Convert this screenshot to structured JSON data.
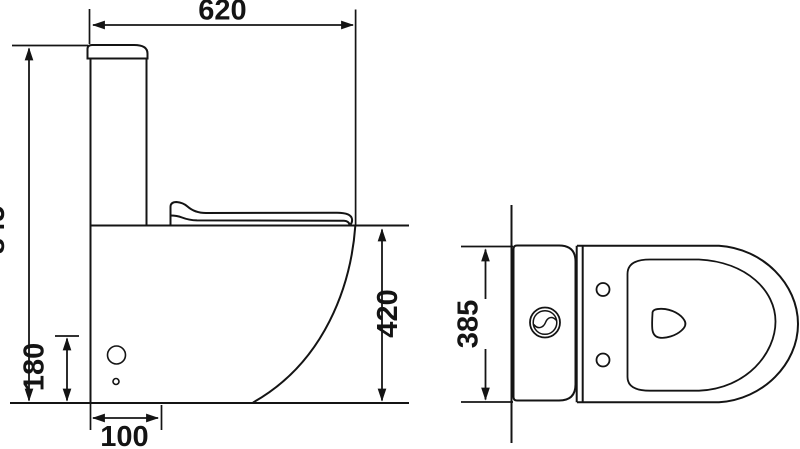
{
  "drawing": {
    "type": "technical-dimension-drawing",
    "subject": "close-coupled toilet",
    "background_color": "#ffffff",
    "line_color": "#141414",
    "views": {
      "side_view_name": "side elevation",
      "top_view_name": "plan view"
    },
    "dimensions": {
      "overall_depth": "620",
      "overall_height": "845",
      "bowl_rim_height": "420",
      "overall_width": "385",
      "outlet_height": "180",
      "outlet_setout": "100"
    }
  }
}
